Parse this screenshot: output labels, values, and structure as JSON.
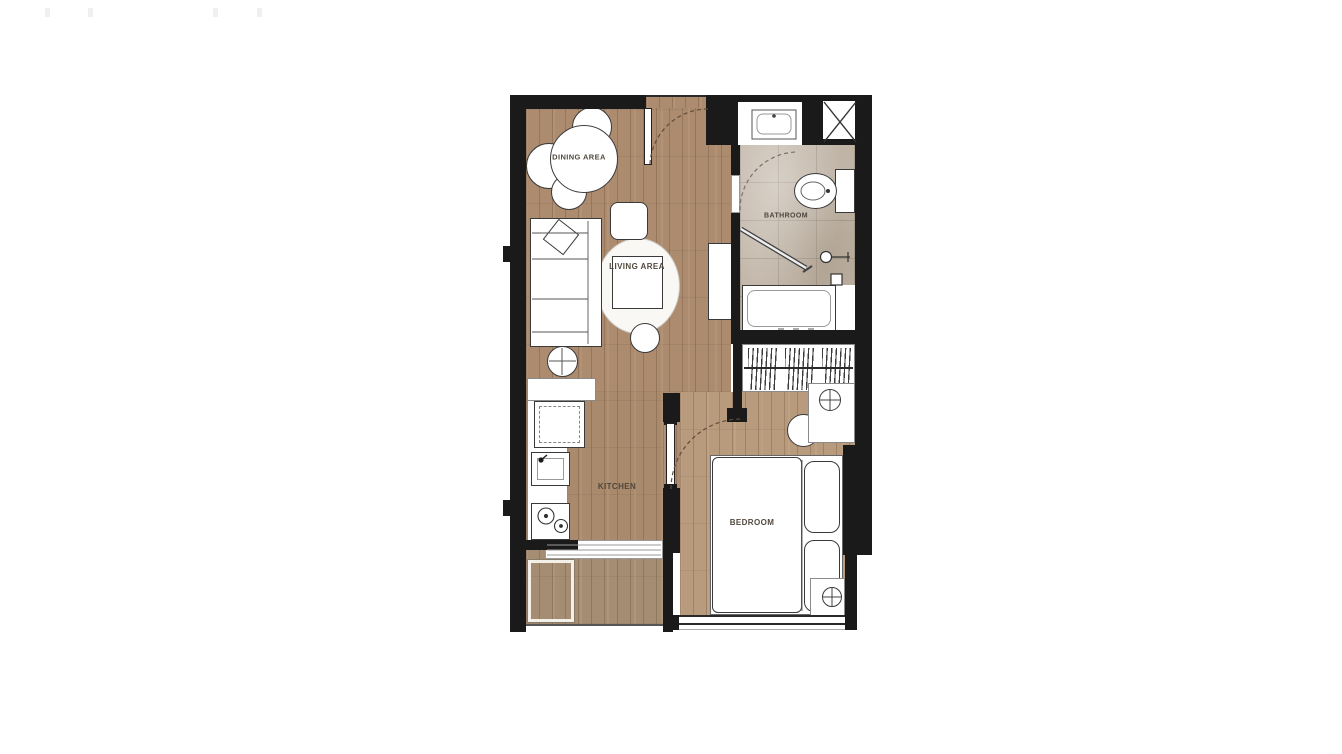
{
  "page": {
    "background": "#ffffff"
  },
  "floor_plan": {
    "rooms": {
      "dining": {
        "label": "DINING AREA"
      },
      "living": {
        "label": "LIVING AREA"
      },
      "bathroom": {
        "label": "BATHROOM"
      },
      "kitchen": {
        "label": "KITCHEN"
      },
      "bedroom": {
        "label": "BEDROOM"
      }
    },
    "colors": {
      "wall": "#1a1a1a",
      "wood_floor": "#ac8b6e",
      "bedroom_floor": "#b89a7c",
      "balcony_deck": "#a58d73",
      "bathroom_tile": "#c0b4a6",
      "fixture_fill": "#ffffff",
      "label_text": "#52493e"
    },
    "fixtures": [
      "dining-table",
      "dining-chair",
      "sofa",
      "throw-pillow",
      "area-rug",
      "coffee-table",
      "floor-cushion",
      "pouf",
      "side-table",
      "tv-console",
      "refrigerator",
      "kitchen-sink",
      "cooktop",
      "kitchen-counter",
      "entry-door",
      "bathroom-door",
      "bedroom-door",
      "vanity-basin",
      "toilet",
      "shower-screen",
      "shower-mixer",
      "bathtub",
      "service-shaft",
      "wardrobe",
      "bed",
      "mattress",
      "pillow",
      "nightstand",
      "table-lamp",
      "stool",
      "sliding-door",
      "balcony",
      "window"
    ]
  }
}
